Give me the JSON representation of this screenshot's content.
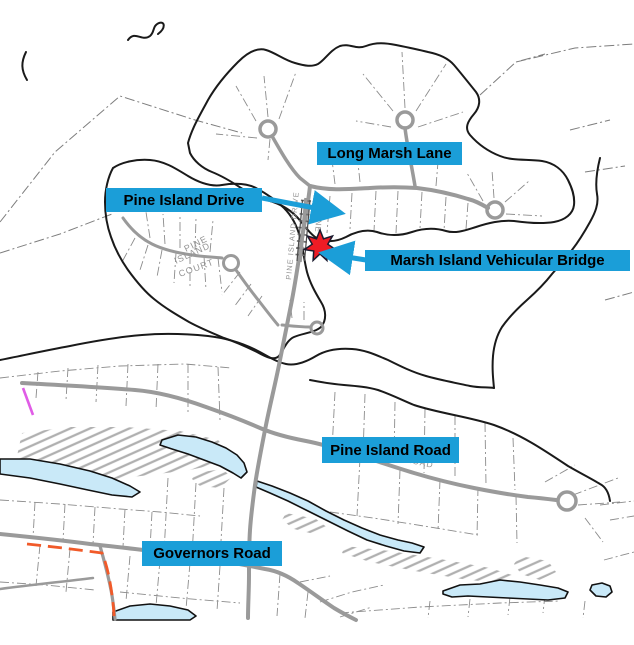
{
  "map": {
    "callouts": {
      "long_marsh_lane": "Long Marsh Lane",
      "pine_island_drive": "Pine Island Drive",
      "marsh_island_vehicular_bridge": "Marsh Island Vehicular Bridge",
      "pine_island_road": "Pine Island Road",
      "governors_road": "Governors Road"
    },
    "street_text": {
      "pine": "PINE",
      "island": "ISLAND",
      "court": "COURT",
      "drive_along_road": "PINE ISLAND DRIVE",
      "drive_fragment": "PINE",
      "road_fragment": "ROAD"
    },
    "marker": {
      "shape": "star",
      "meaning": "bridge location"
    },
    "colors": {
      "callout_bg": "#1B9ED8",
      "callout_text": "#000000",
      "arrow": "#1B9ED8",
      "star_fill": "#EE1C25",
      "water_fill": "#C9E9F8",
      "road_gray": "#9A9A9A",
      "shoreline_black": "#1A1A1A",
      "parcel_gray": "#8C8C8C",
      "boundary_orange": "#F15A29",
      "boundary_magenta": "#E05CE6"
    }
  }
}
